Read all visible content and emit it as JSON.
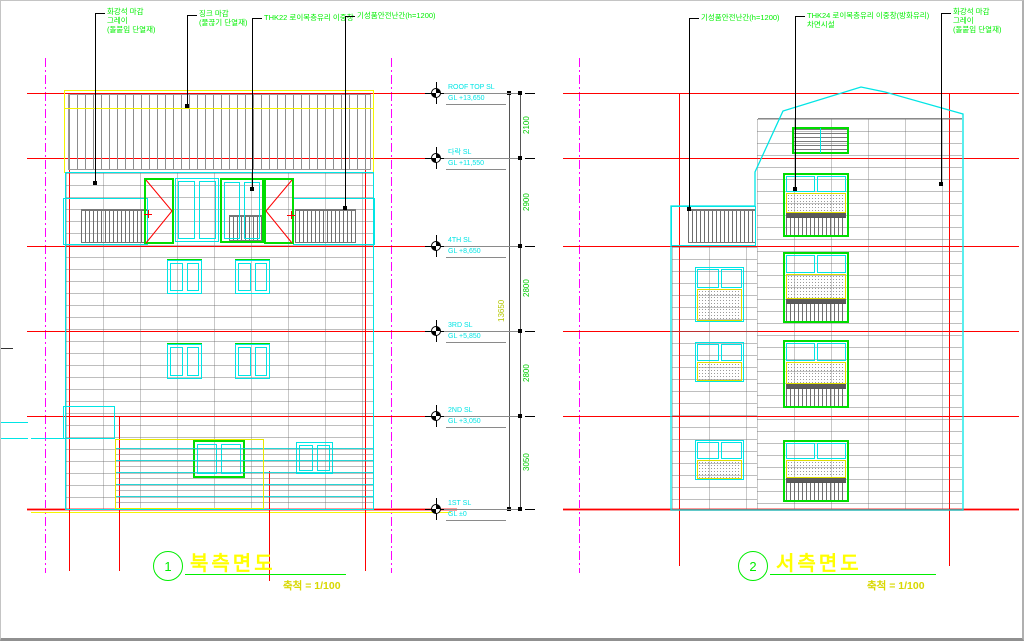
{
  "drawing_type": "architectural-elevation-cad",
  "colors": {
    "grid_line": "#ff00ff",
    "level_line": "#ff0000",
    "outline": "#00e5e5",
    "annotation": "#00ef00",
    "finish_band": "#f5f500",
    "title_text": "#ffff00",
    "dimension_text": "#00cc00"
  },
  "annotations": {
    "left": [
      {
        "text": "화강석 마감\n그레이\n(돌붙임 단열재)"
      },
      {
        "text": "징크 마감\n(물끊기 단열재)"
      },
      {
        "text": "THK22 로이복층유리 이중창"
      },
      {
        "text": "기성품안전난간(h=1200)"
      }
    ],
    "right": [
      {
        "text": "기성품안전난간(h=1200)"
      },
      {
        "text": "THK24 로이복층유리 이중창(방화유리)\n차면시설"
      },
      {
        "text": "화강석 마감\n그레이\n(돌붙임 단열재)"
      }
    ]
  },
  "levels": [
    {
      "name": "ROOF TOP SL",
      "gl": "GL +13,650"
    },
    {
      "name": "다락 SL",
      "gl": "GL +11,550"
    },
    {
      "name": "4TH SL",
      "gl": "GL +8,650"
    },
    {
      "name": "3RD SL",
      "gl": "GL +5,850"
    },
    {
      "name": "2ND SL",
      "gl": "GL +3,050"
    },
    {
      "name": "1ST SL",
      "gl": "GL ±0"
    }
  ],
  "dimensions": {
    "segments": [
      "2100",
      "2900",
      "2800",
      "2800",
      "3050"
    ],
    "total": "13650"
  },
  "titles": [
    {
      "number": "1",
      "title": "북측면도",
      "scale": "축척 = 1/100"
    },
    {
      "number": "2",
      "title": "서측면도",
      "scale": "축척 = 1/100"
    }
  ]
}
